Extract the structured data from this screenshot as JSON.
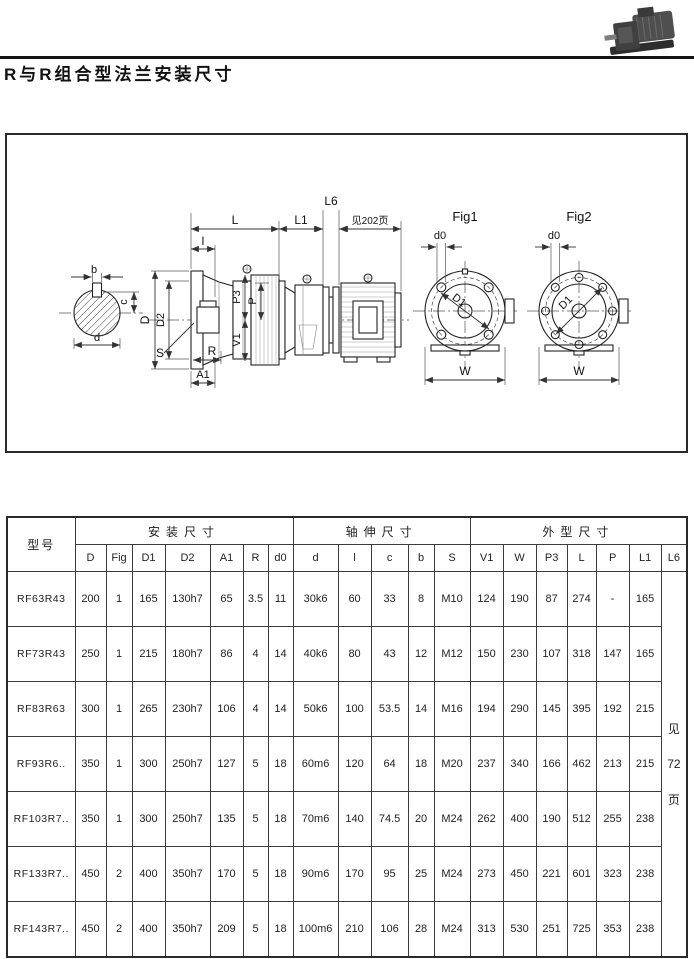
{
  "page": {
    "title": "R与R组合型法兰安装尺寸"
  },
  "diagram": {
    "labels": {
      "L": "L",
      "L1": "L1",
      "L6": "L6",
      "see_page_202": "见202页",
      "l": "l",
      "D": "D",
      "D2": "D2",
      "P3": "P3",
      "P": "P",
      "V1": "V1",
      "S": "S",
      "R": "R",
      "A1": "A1",
      "b": "b",
      "c": "c",
      "d": "d",
      "d0": "d0",
      "D1": "D1",
      "W": "W",
      "fig1": "Fig1",
      "fig2": "Fig2"
    }
  },
  "table": {
    "model_header": "型号",
    "groups": [
      {
        "label": "安装尺寸",
        "cols": [
          "D",
          "Fig",
          "D1",
          "D2",
          "A1",
          "R",
          "d0"
        ]
      },
      {
        "label": "轴伸尺寸",
        "cols": [
          "d",
          "l",
          "c",
          "b",
          "S"
        ]
      },
      {
        "label": "外型尺寸",
        "cols": [
          "V1",
          "W",
          "P3",
          "L",
          "P",
          "L1",
          "L6"
        ]
      }
    ],
    "note_l6": [
      "见",
      "72",
      "页"
    ],
    "rows": [
      {
        "model": "RF63R43",
        "values": [
          "200",
          "1",
          "165",
          "130h7",
          "65",
          "3.5",
          "11",
          "30k6",
          "60",
          "33",
          "8",
          "M10",
          "124",
          "190",
          "87",
          "274",
          "-",
          "165"
        ]
      },
      {
        "model": "RF73R43",
        "values": [
          "250",
          "1",
          "215",
          "180h7",
          "86",
          "4",
          "14",
          "40k6",
          "80",
          "43",
          "12",
          "M12",
          "150",
          "230",
          "107",
          "318",
          "147",
          "165"
        ]
      },
      {
        "model": "RF83R63",
        "values": [
          "300",
          "1",
          "265",
          "230h7",
          "106",
          "4",
          "14",
          "50k6",
          "100",
          "53.5",
          "14",
          "M16",
          "194",
          "290",
          "145",
          "395",
          "192",
          "215"
        ]
      },
      {
        "model": "RF93R6..",
        "values": [
          "350",
          "1",
          "300",
          "250h7",
          "127",
          "5",
          "18",
          "60m6",
          "120",
          "64",
          "18",
          "M20",
          "237",
          "340",
          "166",
          "462",
          "213",
          "215"
        ]
      },
      {
        "model": "RF103R7..",
        "values": [
          "350",
          "1",
          "300",
          "250h7",
          "135",
          "5",
          "18",
          "70m6",
          "140",
          "74.5",
          "20",
          "M24",
          "262",
          "400",
          "190",
          "512",
          "255",
          "238"
        ]
      },
      {
        "model": "RF133R7..",
        "values": [
          "450",
          "2",
          "400",
          "350h7",
          "170",
          "5",
          "18",
          "90m6",
          "170",
          "95",
          "25",
          "M24",
          "273",
          "450",
          "221",
          "601",
          "323",
          "238"
        ]
      },
      {
        "model": "RF143R7..",
        "values": [
          "450",
          "2",
          "400",
          "350h7",
          "209",
          "5",
          "18",
          "100m6",
          "210",
          "106",
          "28",
          "M24",
          "313",
          "530",
          "251",
          "725",
          "353",
          "238"
        ]
      }
    ]
  }
}
